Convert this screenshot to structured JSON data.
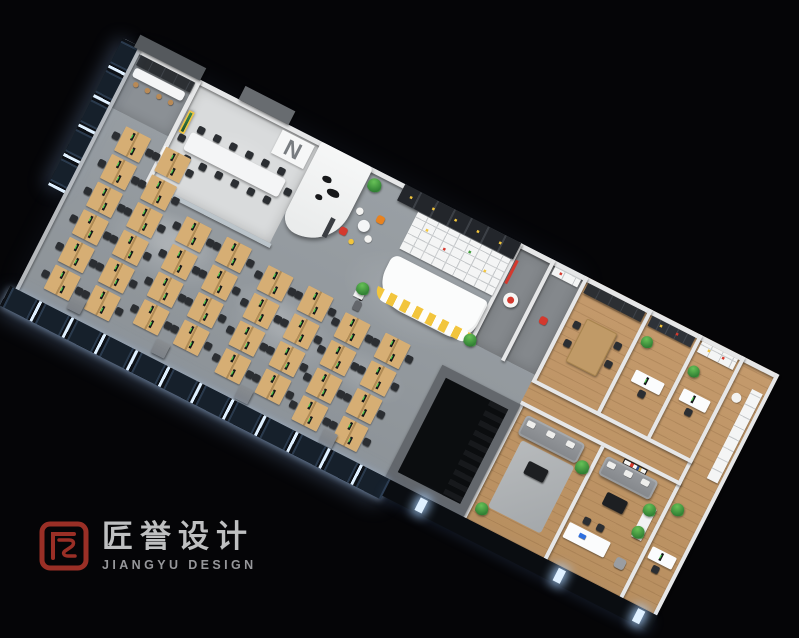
{
  "branding": {
    "logo_cn": "匠誉设计",
    "logo_en": "JIANGYU DESIGN",
    "brand_red": "#9a2f26",
    "cn_text_color": "#bfc0c1",
    "en_text_color": "#96979a"
  },
  "scene": {
    "type": "aerial-3d-cutaway-office-floorplan-render",
    "wall_letter": "N",
    "colors": {
      "concrete": "#9aa0a5",
      "concrete2": "#8d9398",
      "wood": "#c49a6c",
      "wood2": "#b88f60",
      "wall": "#e6e7e8",
      "dark": "#25282d",
      "locker": "#23262b",
      "yellow": "#f2c53d",
      "orange": "#e8821f",
      "red": "#d4392e",
      "plant": "#3f9d3a",
      "plant2": "#2e7d32",
      "chair": "#2b2e32",
      "desk": "#d6ae74",
      "desk2": "#b08b55",
      "glow": "#dff0ff",
      "frame": "#2a3a4d",
      "night": "#0d1117",
      "roomdark": "#84888c",
      "cncol": "#bfc0c1",
      "encol": "#96979a"
    },
    "open_office": {
      "desk_rows": [
        {
          "x": 50,
          "y": 150,
          "pairs": 6
        },
        {
          "x": 140,
          "y": 150,
          "pairs": 6
        },
        {
          "x": 240,
          "y": 255,
          "pairs": 4
        },
        {
          "x": 330,
          "y": 255,
          "pairs": 4
        },
        {
          "x": 430,
          "y": 268,
          "pairs": 4
        },
        {
          "x": 520,
          "y": 268,
          "pairs": 4
        },
        {
          "x": 610,
          "y": 282,
          "pairs": 4
        },
        {
          "x": 700,
          "y": 282,
          "pairs": 4
        }
      ]
    }
  }
}
